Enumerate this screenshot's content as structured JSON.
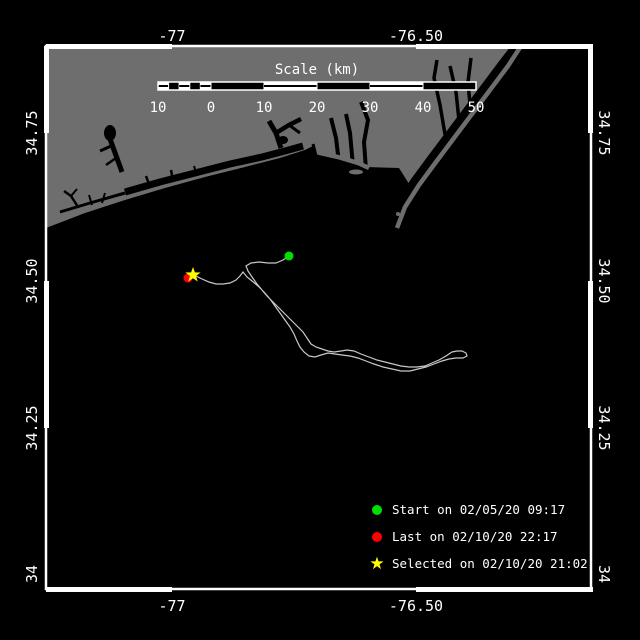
{
  "map": {
    "top_axis": [
      "-77",
      "-76.50"
    ],
    "bottom_axis": [
      "-77",
      "-76.50"
    ],
    "left_axis": [
      "34.75",
      "34.50",
      "34.25",
      "34"
    ],
    "right_axis": [
      "34.75",
      "34.50",
      "34.25",
      "34"
    ],
    "scale_bar": {
      "title": "Scale (km)",
      "tick_labels": [
        "10",
        "0",
        "10",
        "20",
        "30",
        "40",
        "50"
      ]
    },
    "legend": {
      "start": {
        "label": "Start on 02/05/20 09:17",
        "color": "#00e000",
        "marker": "circle"
      },
      "last": {
        "label": "Last on 02/10/20 22:17",
        "color": "#ff0000",
        "marker": "circle"
      },
      "selected": {
        "label": "Selected on 02/10/20 21:02",
        "color": "#ffff00",
        "marker": "star"
      }
    },
    "markers": {
      "start": {
        "x": 289,
        "y": 256
      },
      "last": {
        "x": 188,
        "y": 278
      },
      "selected": {
        "x": 193,
        "y": 275
      }
    },
    "colors": {
      "land": "#6e6e6e",
      "water": "#000000",
      "track": "#c8c8c8",
      "frame": "#ffffff",
      "text": "#ffffff"
    },
    "track_points": [
      [
        289,
        256
      ],
      [
        283,
        260
      ],
      [
        276,
        263
      ],
      [
        268,
        263
      ],
      [
        259,
        262
      ],
      [
        251,
        263
      ],
      [
        246,
        266
      ],
      [
        248,
        271
      ],
      [
        252,
        277
      ],
      [
        257,
        284
      ],
      [
        262,
        290
      ],
      [
        267,
        296
      ],
      [
        273,
        302
      ],
      [
        279,
        308
      ],
      [
        285,
        314
      ],
      [
        291,
        320
      ],
      [
        297,
        326
      ],
      [
        303,
        332
      ],
      [
        307,
        338
      ],
      [
        311,
        344
      ],
      [
        316,
        347
      ],
      [
        322,
        349
      ],
      [
        328,
        351
      ],
      [
        334,
        352
      ],
      [
        341,
        351
      ],
      [
        347,
        350
      ],
      [
        354,
        351
      ],
      [
        361,
        354
      ],
      [
        369,
        357
      ],
      [
        377,
        360
      ],
      [
        385,
        362
      ],
      [
        393,
        364
      ],
      [
        401,
        366
      ],
      [
        409,
        367
      ],
      [
        417,
        367
      ],
      [
        425,
        366
      ],
      [
        432,
        363
      ],
      [
        439,
        360
      ],
      [
        446,
        356
      ],
      [
        452,
        352
      ],
      [
        457,
        351
      ],
      [
        462,
        351
      ],
      [
        466,
        353
      ],
      [
        467,
        356
      ],
      [
        463,
        358
      ],
      [
        456,
        358
      ],
      [
        449,
        359
      ],
      [
        442,
        361
      ],
      [
        434,
        364
      ],
      [
        426,
        367
      ],
      [
        418,
        369
      ],
      [
        410,
        371
      ],
      [
        401,
        371
      ],
      [
        392,
        369
      ],
      [
        383,
        367
      ],
      [
        374,
        364
      ],
      [
        366,
        361
      ],
      [
        358,
        358
      ],
      [
        350,
        356
      ],
      [
        342,
        355
      ],
      [
        335,
        354
      ],
      [
        328,
        353
      ],
      [
        321,
        355
      ],
      [
        315,
        357
      ],
      [
        309,
        356
      ],
      [
        304,
        352
      ],
      [
        300,
        347
      ],
      [
        297,
        341
      ],
      [
        294,
        334
      ],
      [
        290,
        327
      ],
      [
        285,
        320
      ],
      [
        280,
        313
      ],
      [
        275,
        306
      ],
      [
        270,
        299
      ],
      [
        264,
        292
      ],
      [
        258,
        286
      ],
      [
        252,
        281
      ],
      [
        247,
        277
      ],
      [
        243,
        272
      ],
      [
        240,
        276
      ],
      [
        236,
        280
      ],
      [
        230,
        283
      ],
      [
        223,
        284
      ],
      [
        216,
        284
      ],
      [
        209,
        282
      ],
      [
        202,
        279
      ],
      [
        196,
        276
      ],
      [
        193,
        275
      ]
    ]
  }
}
